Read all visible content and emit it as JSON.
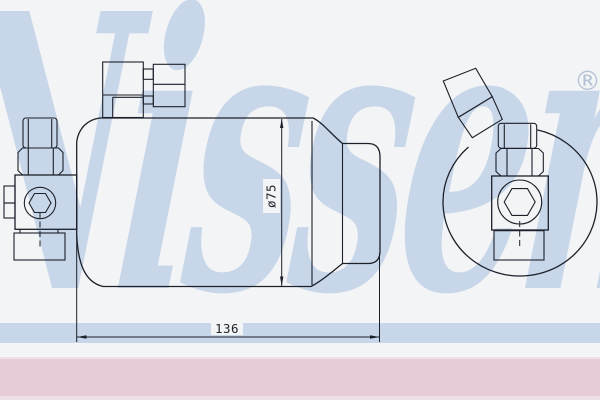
{
  "background_color": "#f3f4f6",
  "watermark": {
    "brand_text": "Nissens",
    "registered_symbol": "®",
    "color": "#c7d6e8"
  },
  "drawing": {
    "line_color": "#1c202a",
    "labels": {
      "diameter": "ø75",
      "length": "136"
    }
  },
  "footer": {
    "bar_color": "#e7cbd6"
  }
}
